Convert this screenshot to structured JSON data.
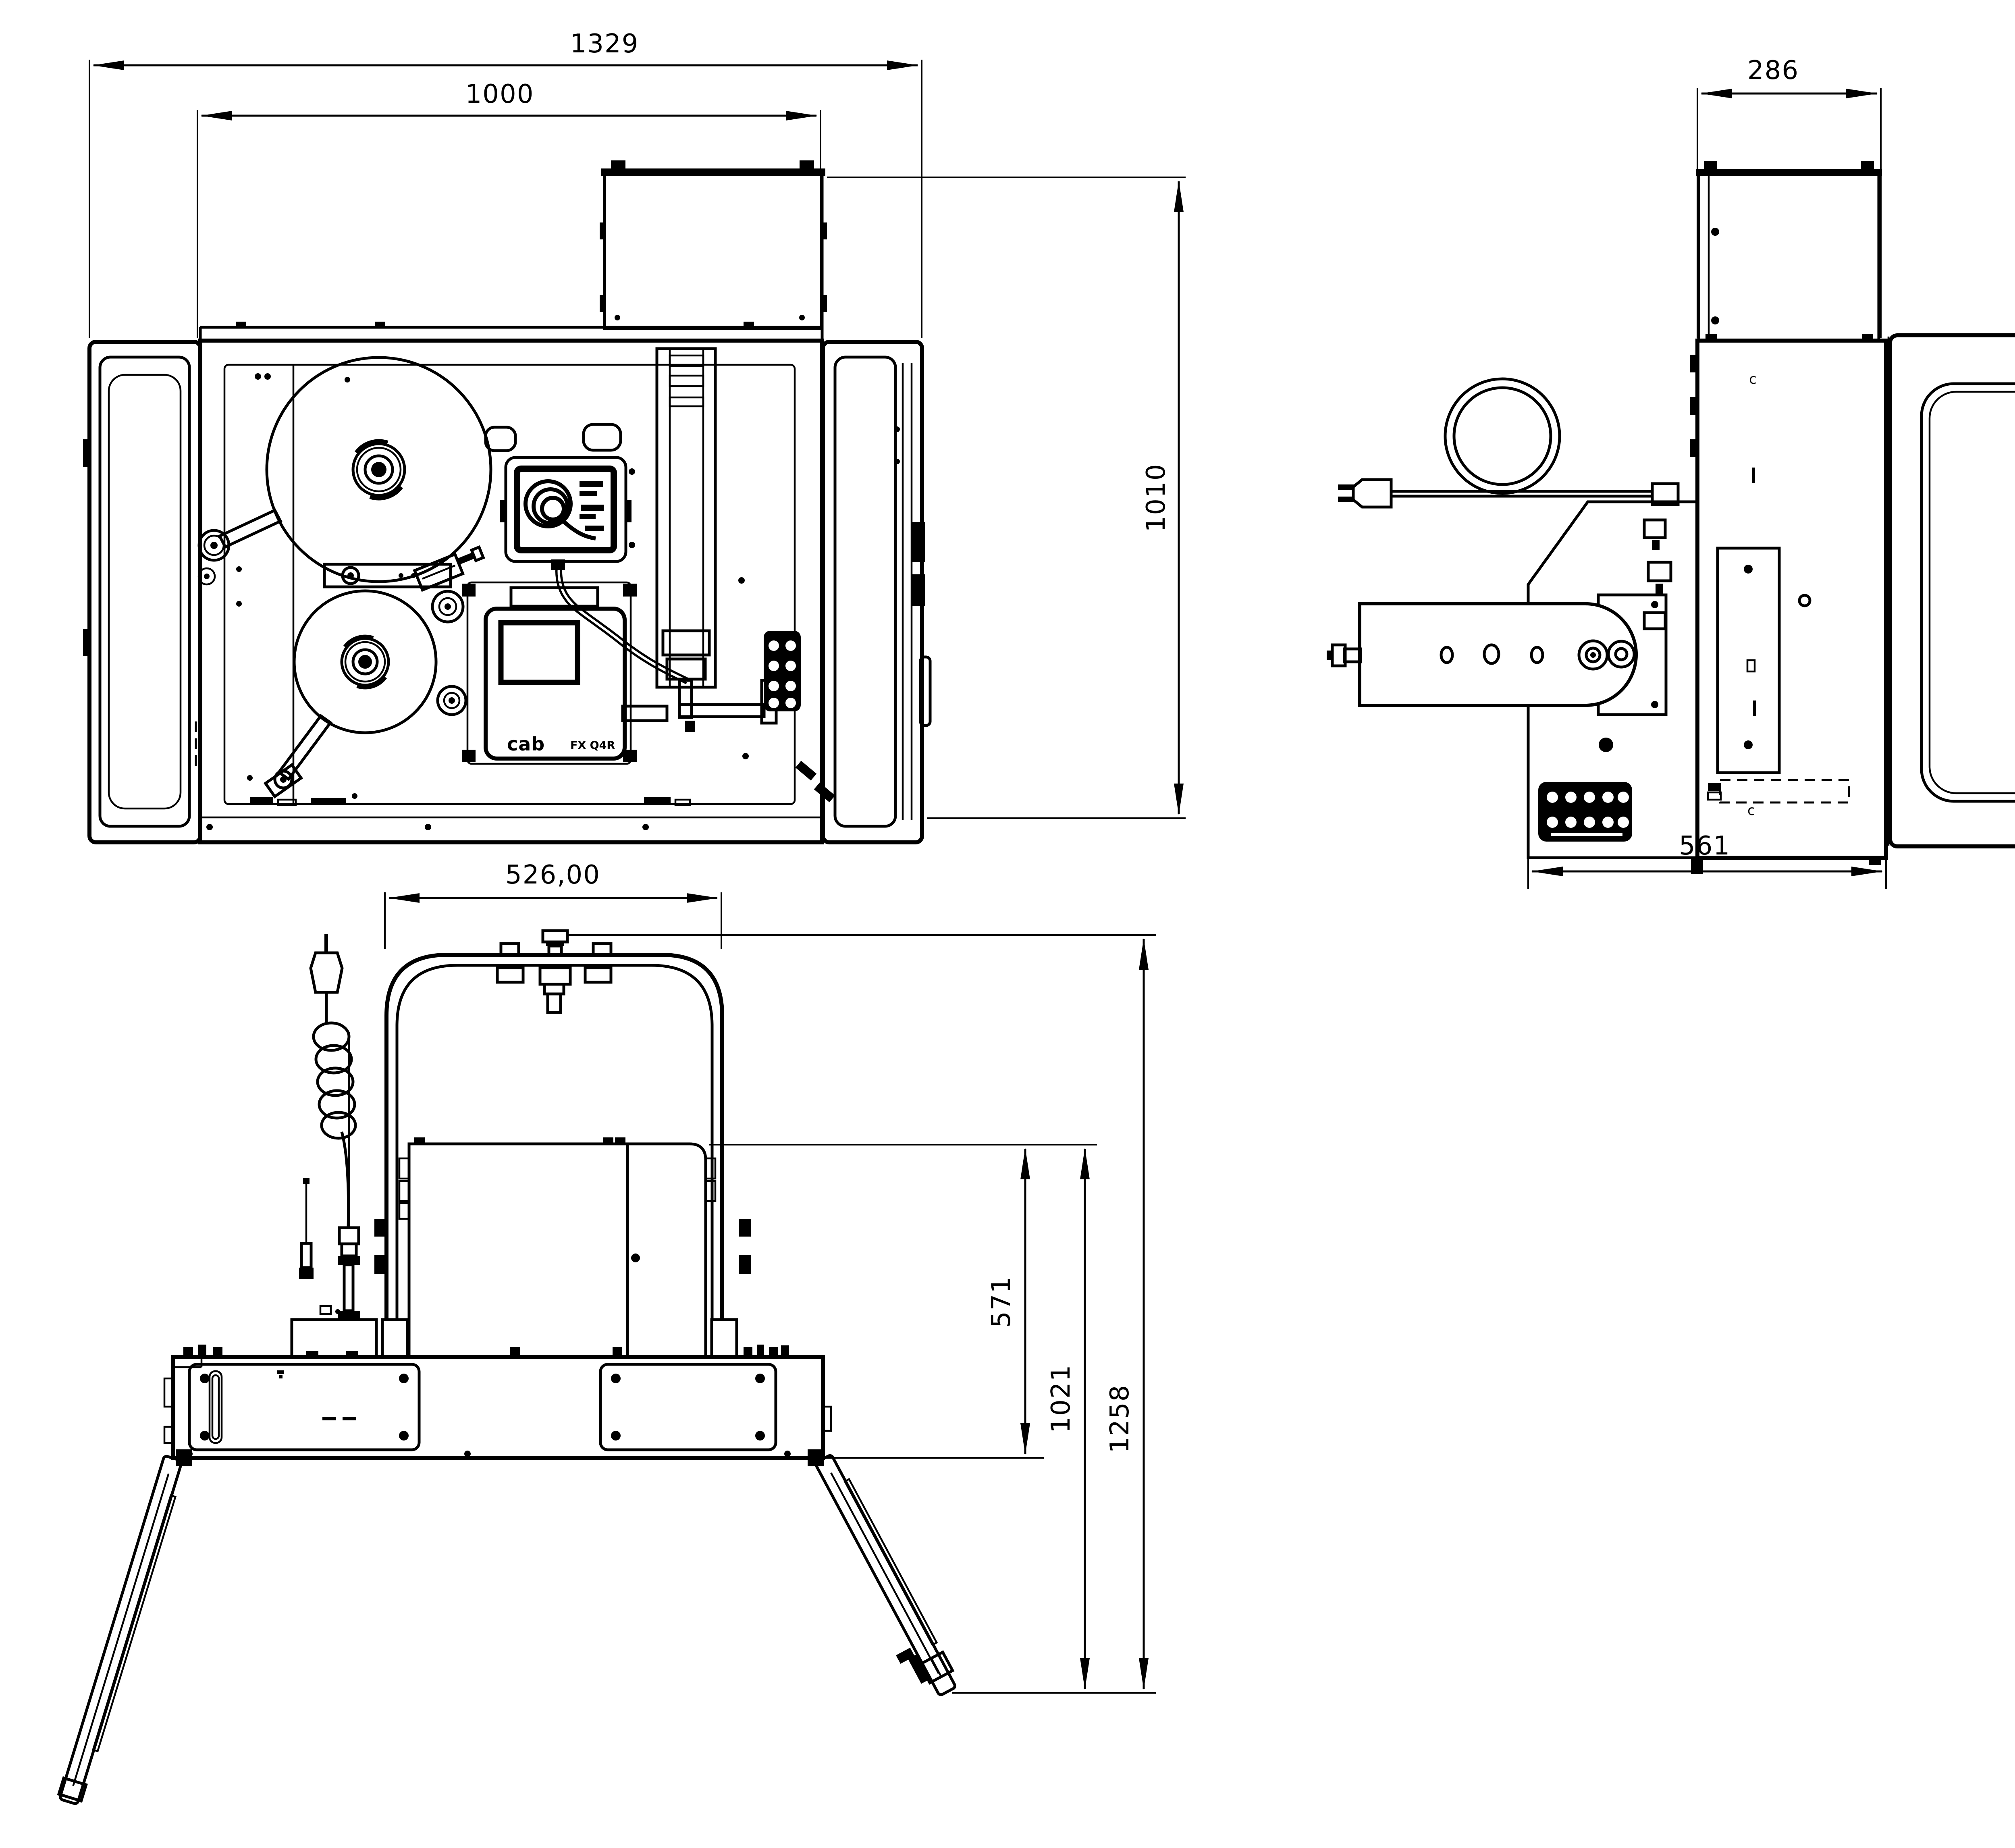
{
  "page": {
    "background": "#ffffff",
    "line_color": "#000000"
  },
  "views": {
    "plan": {
      "dims": {
        "overall_width": "1329",
        "inner_width": "1000",
        "depth": "1010"
      },
      "printer": {
        "brand": "cab",
        "model": "FX Q4R"
      }
    },
    "side": {
      "dims": {
        "top_box_width": "286",
        "height": "1012",
        "body_depth": "561"
      },
      "marks": {
        "c_top": "c",
        "c_bottom": "c"
      }
    },
    "front": {
      "dims": {
        "bracket_width": "526,00",
        "printer_height": "571",
        "mid_height": "1021",
        "total_height": "1258"
      }
    }
  }
}
